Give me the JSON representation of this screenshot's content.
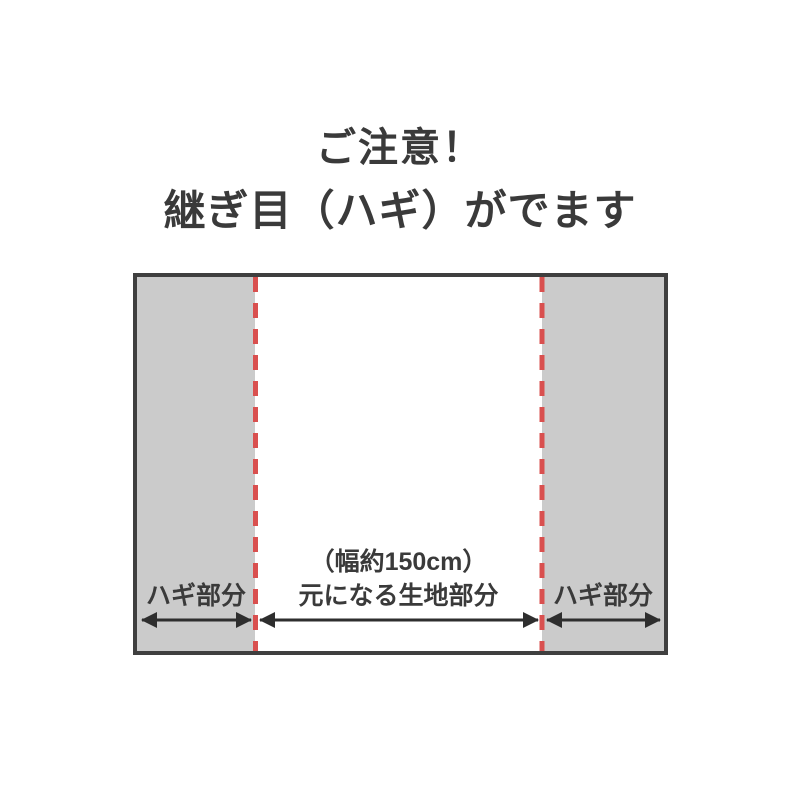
{
  "notice": {
    "title_line1": "ご注意！",
    "title_line2": "継ぎ目（ハギ）がでます"
  },
  "diagram": {
    "left_label": "ハギ部分",
    "center_label_line1": "（幅約150cm）",
    "center_label_line2": "元になる生地部分",
    "right_label": "ハギ部分"
  },
  "colors": {
    "page_bg": "#ffffff",
    "panel_gray": "#cbcbcb",
    "border_dark": "#3f3f3f",
    "seam_red": "#d9504f",
    "arrow_dark": "#2e2e2e",
    "text_dark": "#3a3a3a"
  }
}
